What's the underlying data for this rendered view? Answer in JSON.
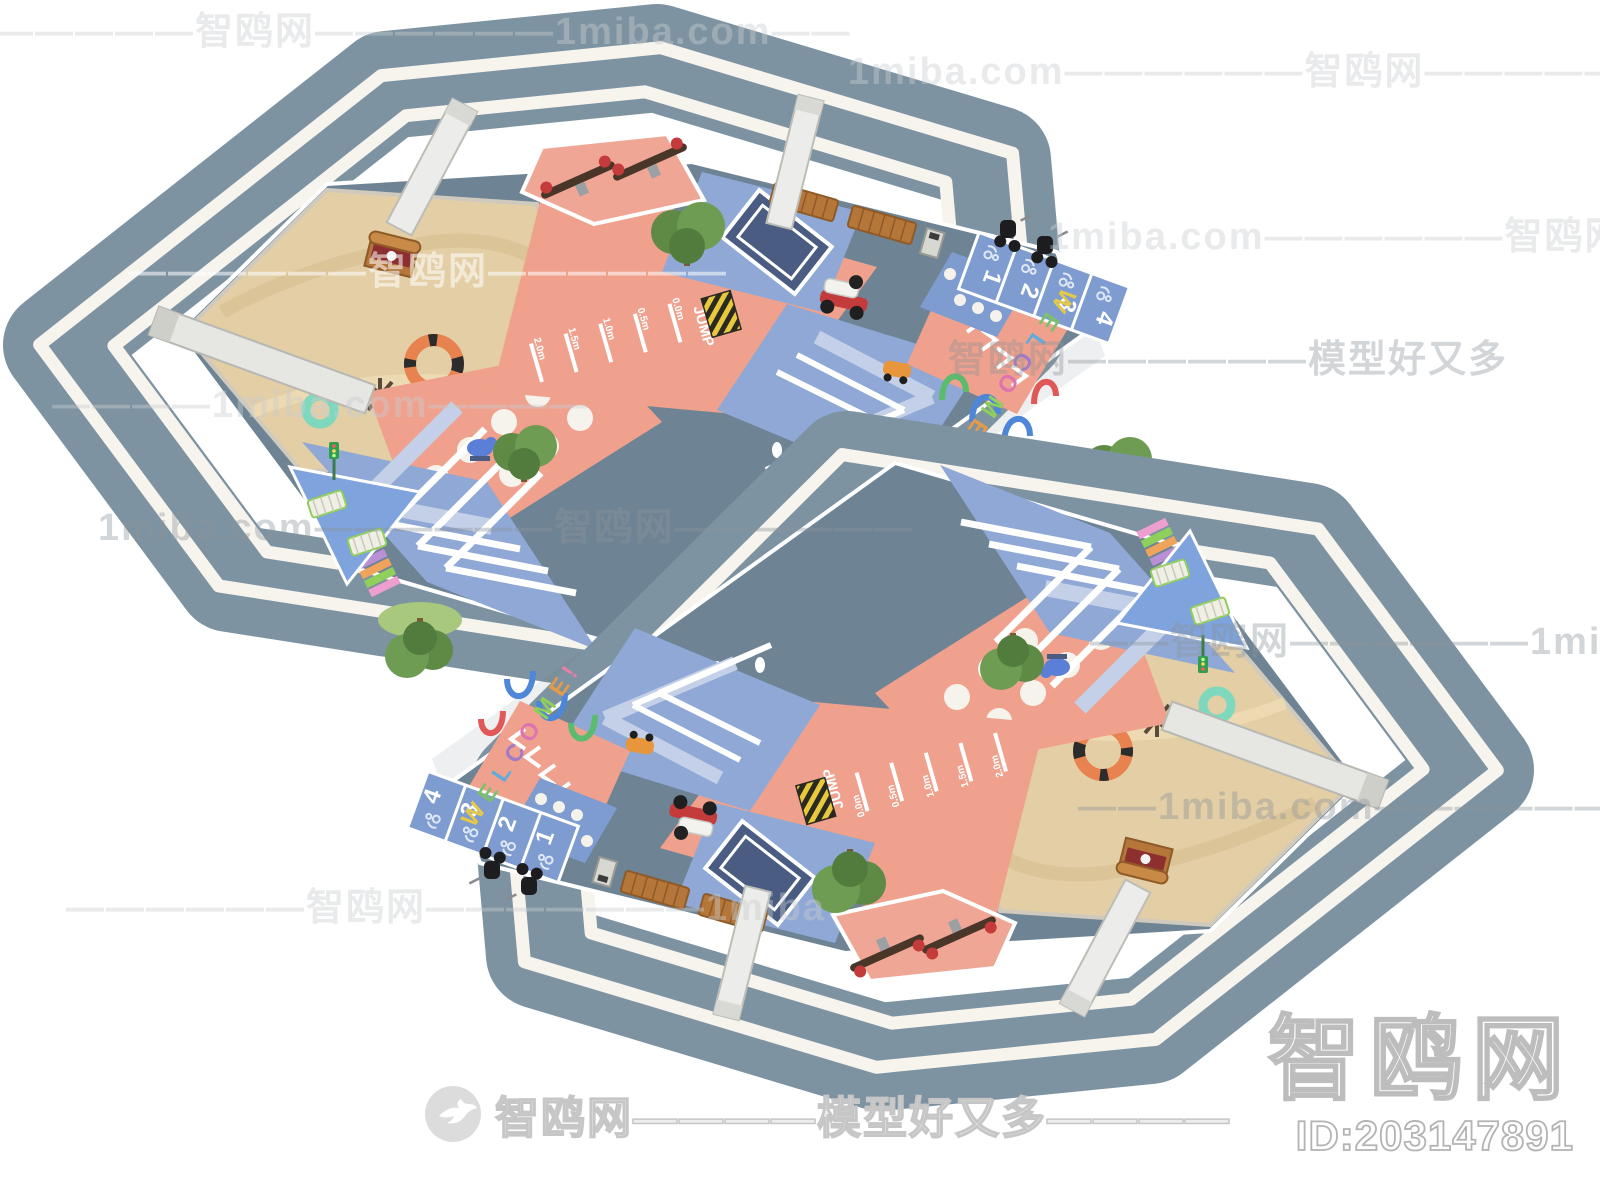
{
  "site": {
    "brand": "智鸥网",
    "domain_label": "1miba.com",
    "slogan": "模型好又多",
    "id_label": "ID:203147891",
    "footer_logo_text": "智鸥网————模型好又多————"
  },
  "watermarks": {
    "tiles": [
      {
        "x": -45,
        "y": 0,
        "cls": "",
        "text": "——————智鸥网——————1miba.com——"
      },
      {
        "x": 848,
        "y": 40,
        "cls": "",
        "text": "1miba.com——————智鸥网——————"
      },
      {
        "x": 1048,
        "y": 205,
        "cls": "",
        "text": "1miba.com——————智鸥网———"
      },
      {
        "x": 128,
        "y": 240,
        "cls": "light",
        "text": "——————智鸥网——————"
      },
      {
        "x": 948,
        "y": 328,
        "cls": "mid",
        "text": "智鸥网——————模型好又多"
      },
      {
        "x": 52,
        "y": 384,
        "cls": "",
        "text": "————1miba.com————"
      },
      {
        "x": 98,
        "y": 496,
        "cls": "mid",
        "text": "1miba.com——————智鸥网——————"
      },
      {
        "x": 1090,
        "y": 610,
        "cls": "mid",
        "text": "——智鸥网——————1miba.com"
      },
      {
        "x": 1078,
        "y": 775,
        "cls": "mid",
        "text": "——1miba.com——————智鸥"
      },
      {
        "x": 66,
        "y": 876,
        "cls": "",
        "text": "——————智鸥网———————1miba"
      }
    ]
  },
  "scene": {
    "welcome": {
      "letters": [
        "W",
        "E",
        "L",
        "C",
        "O",
        "M",
        "E",
        "!"
      ],
      "colors": [
        "#e3c84a",
        "#7cc06e",
        "#64abdb",
        "#a07cc8",
        "#db74b0",
        "#8fcf5c",
        "#e59a49",
        "#e57fa6"
      ]
    },
    "jump": {
      "label": "JUMP",
      "marks": [
        "0.0m",
        "0.5m",
        "1.0m",
        "1.5m",
        "2.0m"
      ]
    },
    "parking": {
      "numbers": [
        "1",
        "2",
        "3",
        "4"
      ]
    }
  },
  "palette": {
    "ring": "#7e93a2",
    "ring_stripe": "#f7f4ee",
    "plaza_base": "#6e8495",
    "sand": "#e3cea5",
    "salmon": "#efa18d",
    "track_blue": "#8fa8d5",
    "navy": "#4a5c82",
    "wood": "#b5763a"
  }
}
